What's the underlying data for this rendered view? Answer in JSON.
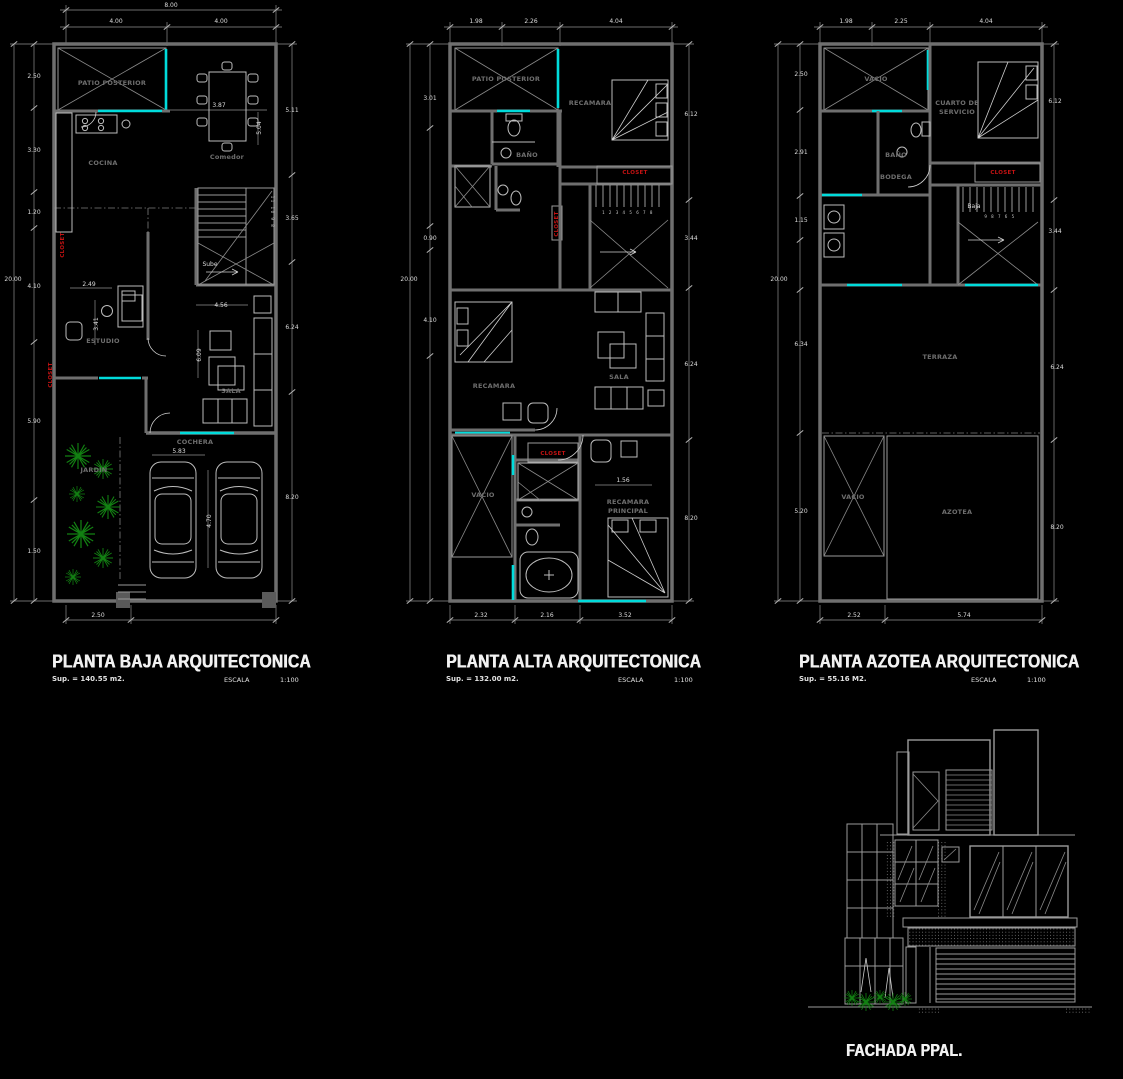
{
  "colors": {
    "background": "#000000",
    "wall_gray": "#6f6f6f",
    "window_cyan": "#00dcdc",
    "closet_red": "#c41212",
    "plant_green": "#128012",
    "dim_text": "#dcdcdc",
    "room_text": "#6e6e6e",
    "title_text": "#f2f2f2"
  },
  "plans": [
    {
      "title": "PLANTA BAJA ARQUITECTONICA",
      "sup": "Sup. = 140.55 m2.",
      "escala_label": "ESCALA",
      "escala_value": "1:100",
      "labels": [
        {
          "t": "PATIO POSTERIOR",
          "x": 112,
          "y": 85,
          "c": "room"
        },
        {
          "t": "COCINA",
          "x": 103,
          "y": 165,
          "c": "room"
        },
        {
          "t": "Comedor",
          "x": 227,
          "y": 159,
          "c": "room"
        },
        {
          "t": "ESTUDIO",
          "x": 103,
          "y": 343,
          "c": "room"
        },
        {
          "t": "SALA",
          "x": 231,
          "y": 393,
          "c": "room"
        },
        {
          "t": "JARDIN",
          "x": 94,
          "y": 472,
          "c": "room"
        },
        {
          "t": "COCHERA",
          "x": 195,
          "y": 444,
          "c": "room"
        },
        {
          "t": "8.00",
          "x": 171,
          "y": 7,
          "c": "dim"
        },
        {
          "t": "4.00",
          "x": 116,
          "y": 23,
          "c": "dim"
        },
        {
          "t": "4.00",
          "x": 221,
          "y": 23,
          "c": "dim"
        },
        {
          "t": "20.00",
          "x": 13,
          "y": 281,
          "c": "dim"
        },
        {
          "t": "2.50",
          "x": 34,
          "y": 78,
          "c": "dim"
        },
        {
          "t": "3.30",
          "x": 34,
          "y": 152,
          "c": "dim"
        },
        {
          "t": "1.20",
          "x": 34,
          "y": 214,
          "c": "dim"
        },
        {
          "t": "4.10",
          "x": 34,
          "y": 288,
          "c": "dim"
        },
        {
          "t": "5.90",
          "x": 34,
          "y": 423,
          "c": "dim"
        },
        {
          "t": "1.50",
          "x": 34,
          "y": 553,
          "c": "dim"
        },
        {
          "t": "5.11",
          "x": 292,
          "y": 112,
          "c": "dim"
        },
        {
          "t": "3.65",
          "x": 292,
          "y": 220,
          "c": "dim"
        },
        {
          "t": "6.24",
          "x": 292,
          "y": 329,
          "c": "dim"
        },
        {
          "t": "8.20",
          "x": 292,
          "y": 499,
          "c": "dim"
        },
        {
          "t": "2.50",
          "x": 98,
          "y": 617,
          "c": "dim"
        },
        {
          "t": "3.87",
          "x": 219,
          "y": 107,
          "c": "dim"
        },
        {
          "t": "5.04",
          "x": 261,
          "y": 128,
          "r": -90,
          "c": "dim"
        },
        {
          "t": "2.49",
          "x": 89,
          "y": 286,
          "c": "dim"
        },
        {
          "t": "3.41",
          "x": 98,
          "y": 324,
          "r": -90,
          "c": "dim"
        },
        {
          "t": "4.56",
          "x": 221,
          "y": 307,
          "c": "dim"
        },
        {
          "t": "6.09",
          "x": 201,
          "y": 355,
          "r": -90,
          "c": "dim"
        },
        {
          "t": "5.83",
          "x": 179,
          "y": 453,
          "c": "dim"
        },
        {
          "t": "4.70",
          "x": 211,
          "y": 521,
          "r": -90,
          "c": "dim"
        },
        {
          "t": "Sube",
          "x": 210,
          "y": 266,
          "c": "dim"
        },
        {
          "t": "11 10 9 8",
          "x": 271,
          "y": 212,
          "r": 90,
          "c": "tiny"
        },
        {
          "t": "CLOSET",
          "x": 64,
          "y": 245,
          "r": -90,
          "c": "closet"
        },
        {
          "t": "CLOSET",
          "x": 52,
          "y": 375,
          "r": -90,
          "c": "closet"
        }
      ]
    },
    {
      "title": "PLANTA ALTA ARQUITECTONICA",
      "sup": "Sup. = 132.00 m2.",
      "escala_label": "ESCALA",
      "escala_value": "1:100",
      "labels": [
        {
          "t": "PATIO POSTERIOR",
          "x": 506,
          "y": 81,
          "c": "room"
        },
        {
          "t": "RECAMARA",
          "x": 590,
          "y": 105,
          "c": "room"
        },
        {
          "t": "BAÑO",
          "x": 527,
          "y": 157,
          "c": "room"
        },
        {
          "t": "RECAMARA",
          "x": 494,
          "y": 388,
          "c": "room"
        },
        {
          "t": "SALA",
          "x": 619,
          "y": 379,
          "c": "room"
        },
        {
          "t": "VACIO",
          "x": 483,
          "y": 497,
          "c": "room"
        },
        {
          "t": "RECAMARA",
          "x": 628,
          "y": 504,
          "c": "room"
        },
        {
          "t": "PRINCIPAL",
          "x": 628,
          "y": 513,
          "c": "room"
        },
        {
          "t": "1.98",
          "x": 476,
          "y": 23,
          "c": "dim"
        },
        {
          "t": "2.26",
          "x": 531,
          "y": 23,
          "c": "dim"
        },
        {
          "t": "4.04",
          "x": 616,
          "y": 23,
          "c": "dim"
        },
        {
          "t": "20.00",
          "x": 409,
          "y": 281,
          "c": "dim"
        },
        {
          "t": "3.01",
          "x": 430,
          "y": 100,
          "c": "dim"
        },
        {
          "t": "0.90",
          "x": 430,
          "y": 240,
          "c": "dim"
        },
        {
          "t": "4.10",
          "x": 430,
          "y": 322,
          "c": "dim"
        },
        {
          "t": "6.12",
          "x": 691,
          "y": 116,
          "c": "dim"
        },
        {
          "t": "3.44",
          "x": 691,
          "y": 240,
          "c": "dim"
        },
        {
          "t": "6.24",
          "x": 691,
          "y": 366,
          "c": "dim"
        },
        {
          "t": "8.20",
          "x": 691,
          "y": 520,
          "c": "dim"
        },
        {
          "t": "2.32",
          "x": 481,
          "y": 617,
          "c": "dim"
        },
        {
          "t": "2.16",
          "x": 547,
          "y": 617,
          "c": "dim"
        },
        {
          "t": "3.52",
          "x": 625,
          "y": 617,
          "c": "dim"
        },
        {
          "t": "1.56",
          "x": 623,
          "y": 482,
          "c": "dim"
        },
        {
          "t": "1 2 3 4 5 6 7 8",
          "x": 628,
          "y": 214,
          "c": "tiny"
        },
        {
          "t": "CLOSET",
          "x": 635,
          "y": 174,
          "c": "closet"
        },
        {
          "t": "CLOSET",
          "x": 553,
          "y": 455,
          "c": "closet"
        },
        {
          "t": "CLOSET",
          "x": 558,
          "y": 224,
          "r": -90,
          "c": "closet"
        }
      ]
    },
    {
      "title": "PLANTA AZOTEA ARQUITECTONICA",
      "sup": "Sup. = 55.16 M2.",
      "escala_label": "ESCALA",
      "escala_value": "1:100",
      "labels": [
        {
          "t": "VACIO",
          "x": 876,
          "y": 81,
          "c": "room"
        },
        {
          "t": "CUARTO DE",
          "x": 957,
          "y": 105,
          "c": "room"
        },
        {
          "t": "SERVICIO",
          "x": 957,
          "y": 114,
          "c": "room"
        },
        {
          "t": "BAÑO",
          "x": 896,
          "y": 157,
          "c": "room"
        },
        {
          "t": "BODEGA",
          "x": 896,
          "y": 179,
          "c": "room"
        },
        {
          "t": "TERRAZA",
          "x": 940,
          "y": 359,
          "c": "room"
        },
        {
          "t": "VACIO",
          "x": 853,
          "y": 499,
          "c": "room"
        },
        {
          "t": "AZOTEA",
          "x": 957,
          "y": 514,
          "c": "room"
        },
        {
          "t": "1.98",
          "x": 846,
          "y": 23,
          "c": "dim"
        },
        {
          "t": "2.25",
          "x": 901,
          "y": 23,
          "c": "dim"
        },
        {
          "t": "4.04",
          "x": 986,
          "y": 23,
          "c": "dim"
        },
        {
          "t": "20.00",
          "x": 779,
          "y": 281,
          "c": "dim"
        },
        {
          "t": "2.50",
          "x": 801,
          "y": 76,
          "c": "dim"
        },
        {
          "t": "2.91",
          "x": 801,
          "y": 154,
          "c": "dim"
        },
        {
          "t": "1.15",
          "x": 801,
          "y": 222,
          "c": "dim"
        },
        {
          "t": "6.34",
          "x": 801,
          "y": 346,
          "c": "dim"
        },
        {
          "t": "5.20",
          "x": 801,
          "y": 513,
          "c": "dim"
        },
        {
          "t": "6.12",
          "x": 1055,
          "y": 103,
          "c": "dim"
        },
        {
          "t": "3.44",
          "x": 1055,
          "y": 233,
          "c": "dim"
        },
        {
          "t": "6.24",
          "x": 1057,
          "y": 369,
          "c": "dim"
        },
        {
          "t": "8.20",
          "x": 1057,
          "y": 529,
          "c": "dim"
        },
        {
          "t": "2.52",
          "x": 854,
          "y": 617,
          "c": "dim"
        },
        {
          "t": "5.74",
          "x": 964,
          "y": 617,
          "c": "dim"
        },
        {
          "t": "Baja",
          "x": 974,
          "y": 208,
          "c": "dim"
        },
        {
          "t": "9 8 7 6 5",
          "x": 1000,
          "y": 218,
          "c": "tiny"
        },
        {
          "t": "CLOSET",
          "x": 1003,
          "y": 174,
          "c": "closet"
        }
      ]
    }
  ],
  "facade": {
    "title": "FACHADA PPAL."
  }
}
